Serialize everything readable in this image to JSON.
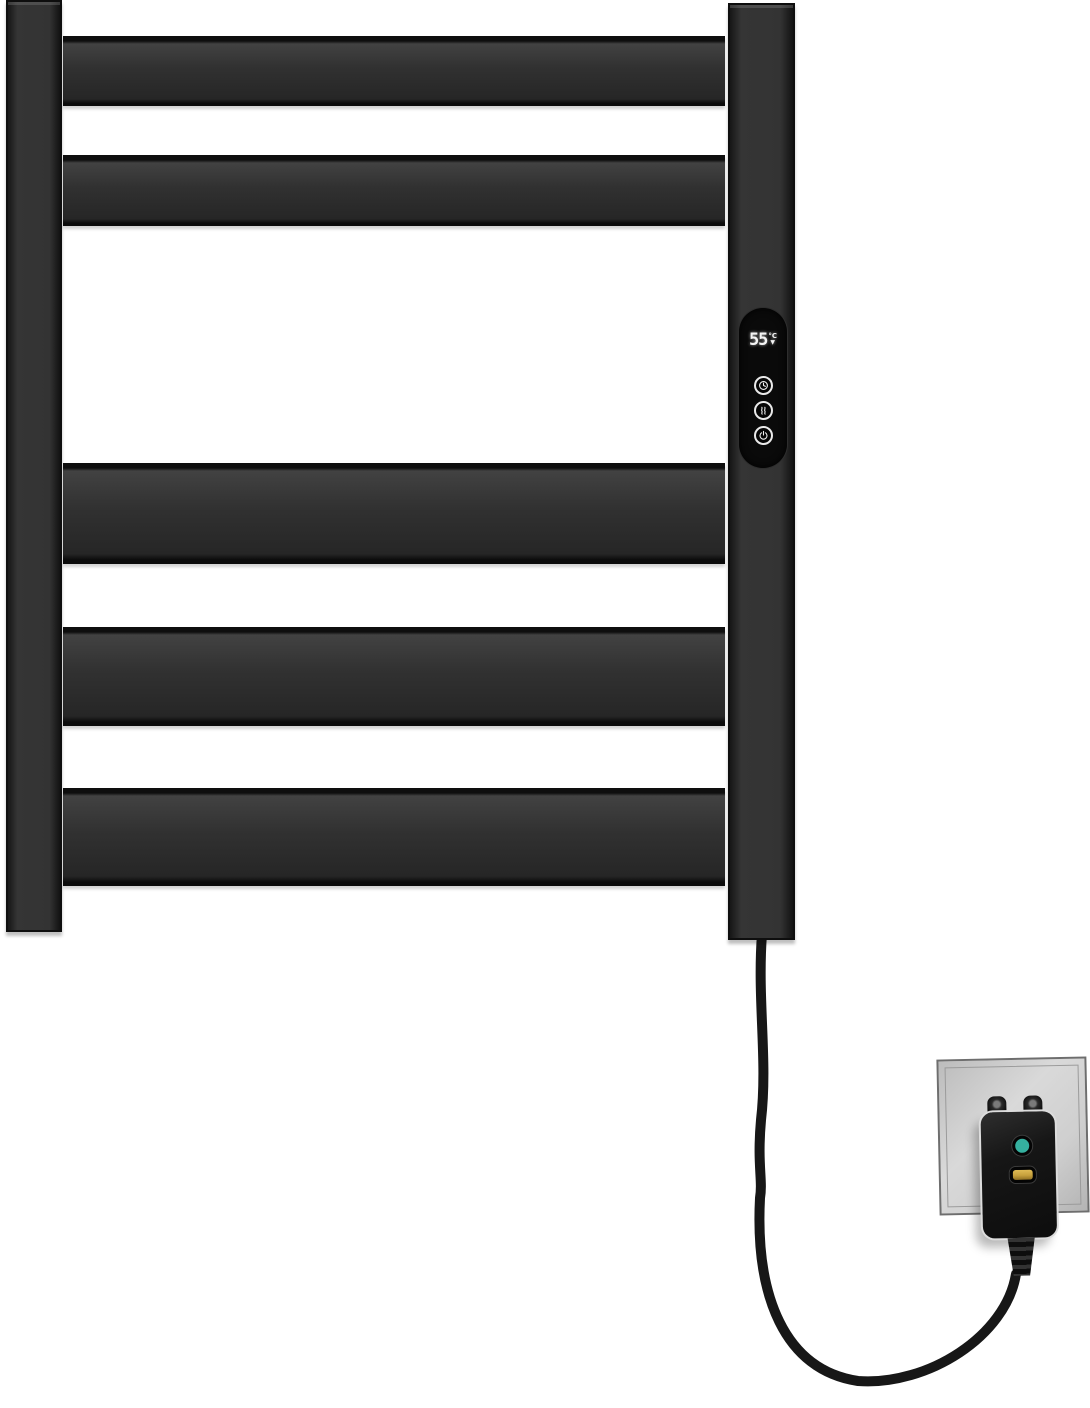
{
  "image": {
    "type": "product-photo",
    "subject": "Black wall-mounted electric heated towel rail with digital temperature control, power cord and leakage-protection plug in a wall outlet",
    "background_color": "#ffffff"
  },
  "rail": {
    "bar_count": 5,
    "rail_color": "#313131",
    "edge_color": "#0d0d0d"
  },
  "panel": {
    "panel_color": "#0a0a0a",
    "display": {
      "temperature": "55",
      "unit": "°C",
      "indicator": "▼"
    },
    "buttons": [
      {
        "label": "timer",
        "icon": "clock-icon"
      },
      {
        "label": "heat",
        "icon": "steam-icon"
      },
      {
        "label": "power",
        "icon": "power-icon"
      }
    ]
  },
  "outlet": {
    "plate_color": "#cccccc",
    "plug_color": "#141414",
    "cord_color": "#171717",
    "buttons": [
      {
        "label": "reset",
        "color": "#35b09f"
      },
      {
        "label": "test",
        "color": "#c7a13d"
      }
    ]
  }
}
